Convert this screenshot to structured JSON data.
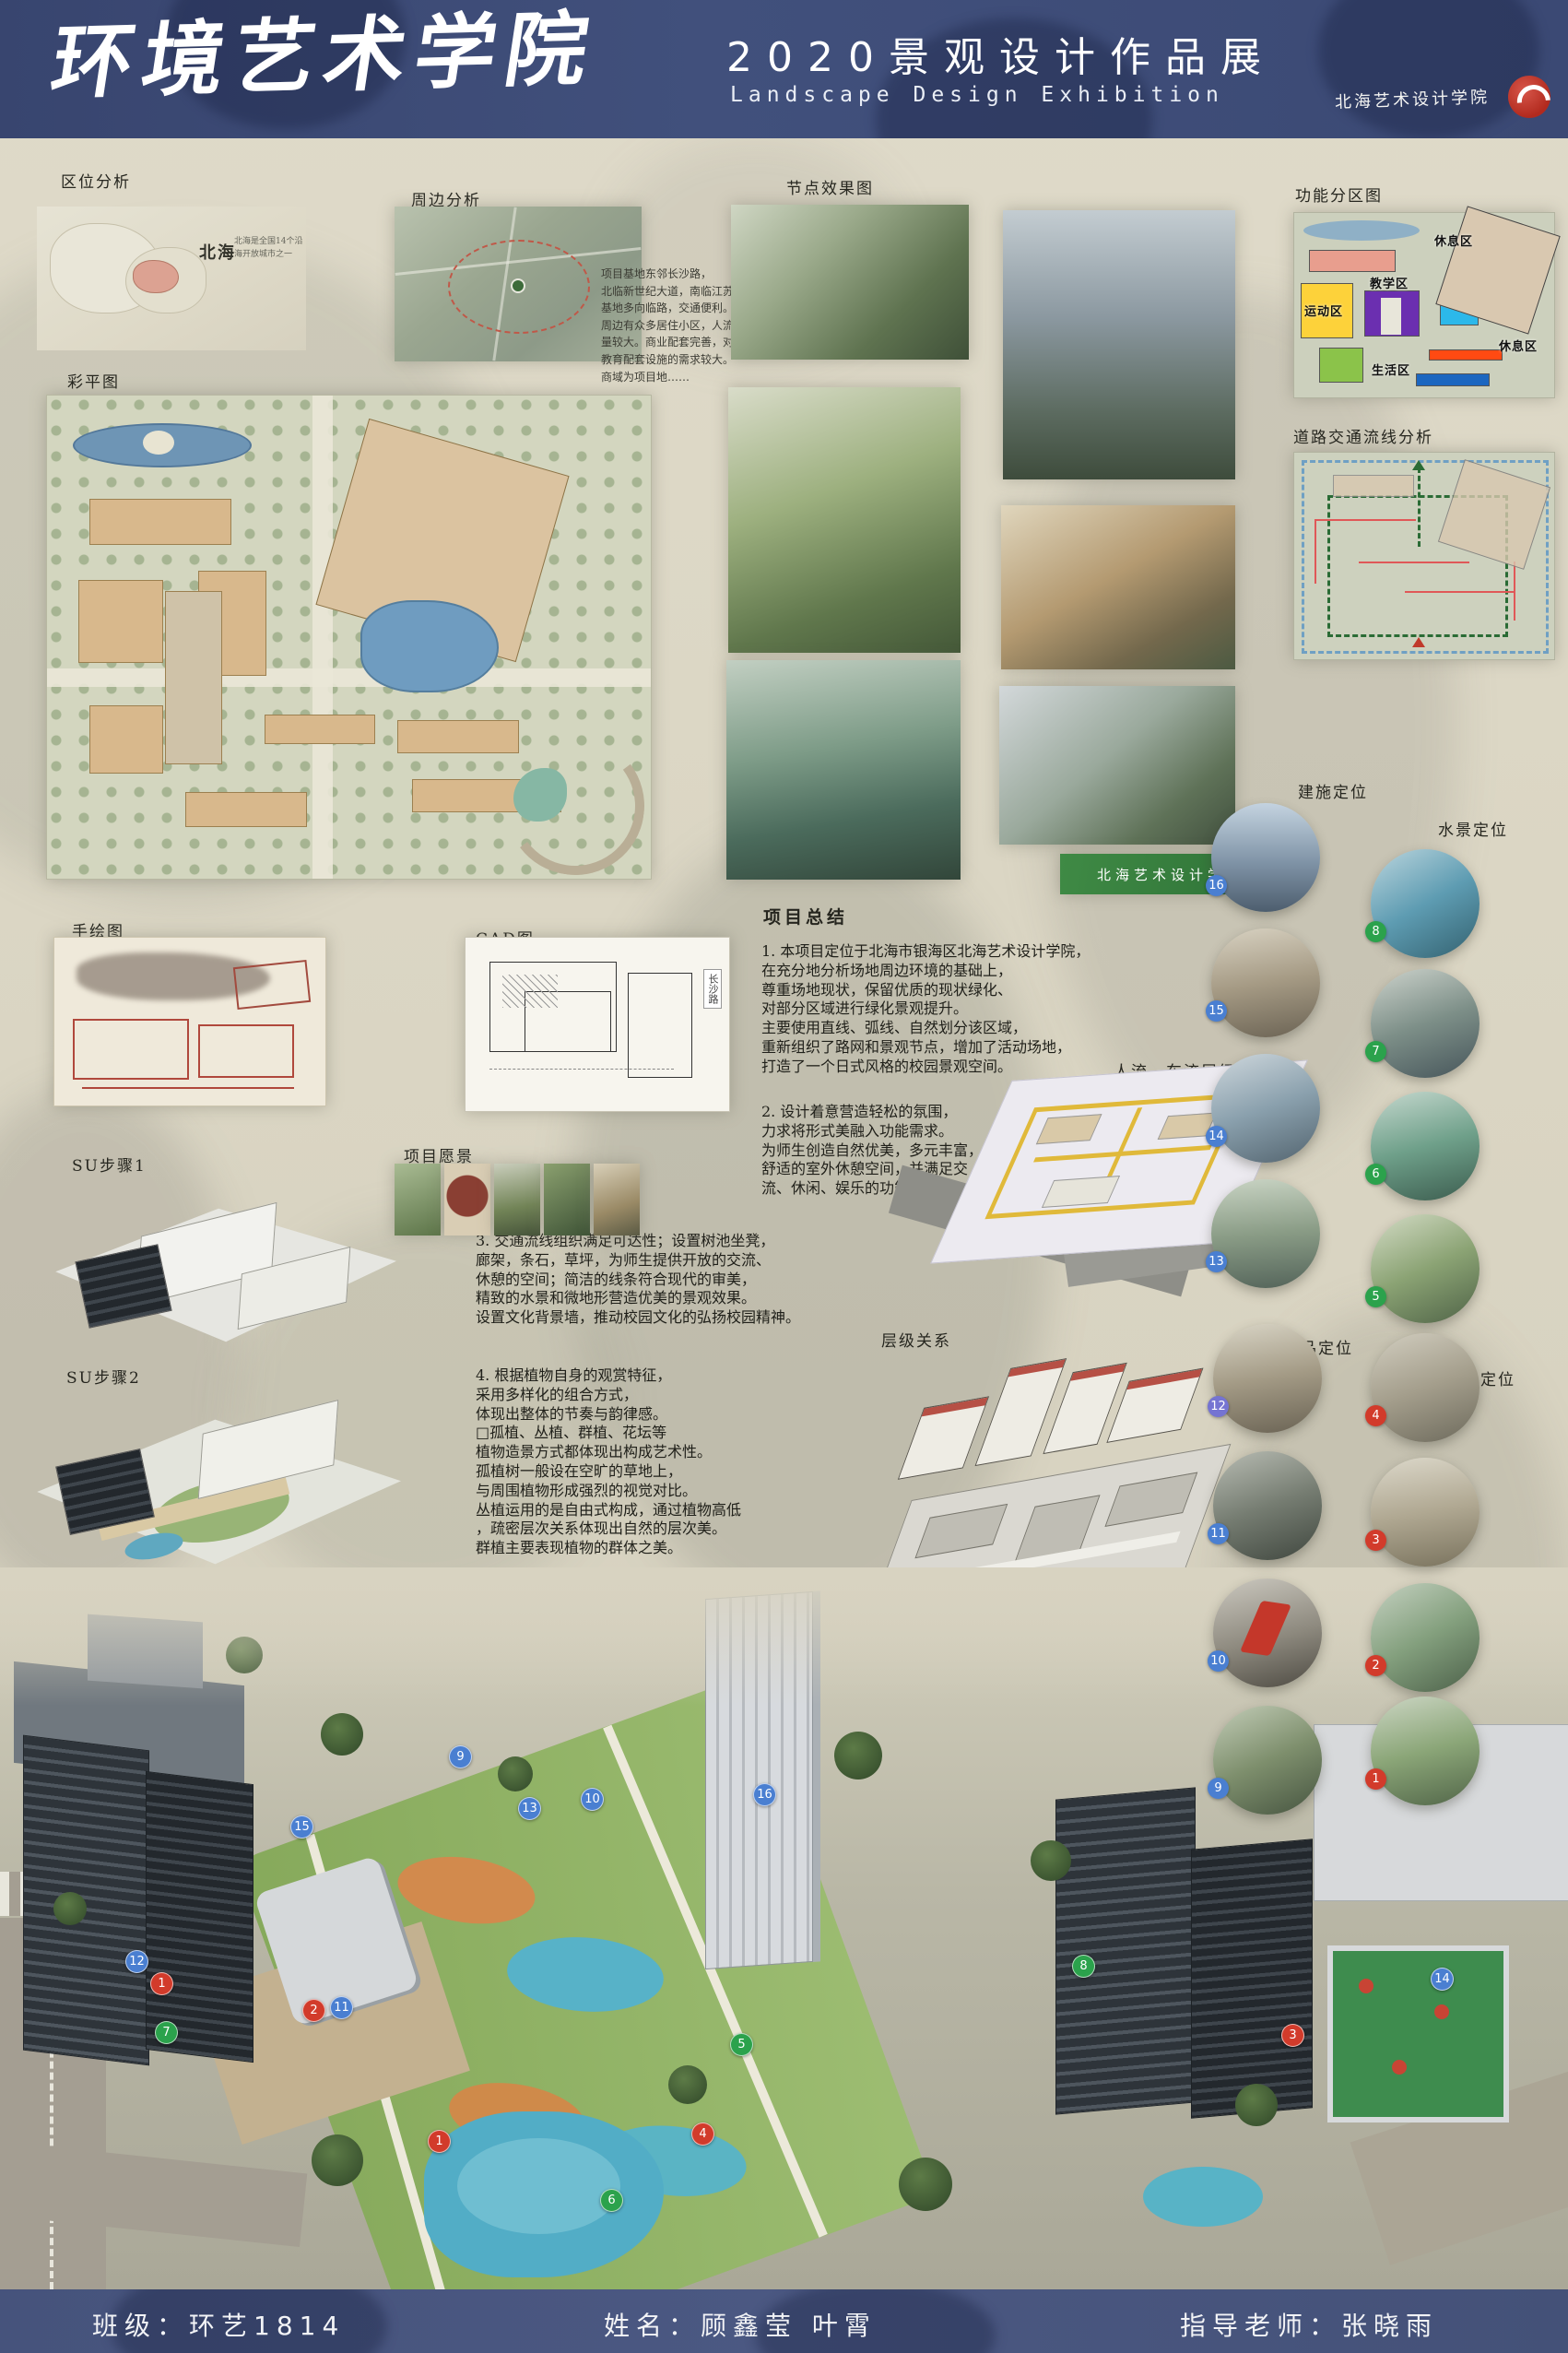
{
  "header": {
    "title": "环境艺术学院",
    "subtitle": "2020景观设计作品展",
    "subtitle_en": "Landscape Design Exhibition",
    "seal_text": "北海艺术设计学院"
  },
  "labels": {
    "location": "区位分析",
    "surrounding": "周边分析",
    "node_effects": "节点效果图",
    "function_zoning": "功能分区图",
    "traffic": "道路交通流线分析",
    "color_plan": "彩平图",
    "hand_drawing": "手绘图",
    "cad": "CAD图",
    "summary": "项目总结",
    "su_step1": "SU步骤1",
    "vision": "项目愿景",
    "su_step2": "SU步骤2",
    "aerial": "鸟瞰图",
    "flow": "人流，车流层级图",
    "hierarchy": "层级关系",
    "building_pos": "建施定位",
    "water_pos": "水景定位",
    "feature_pos": "小品定位",
    "paving_pos": "铺装定位"
  },
  "location_map": {
    "city": "北海",
    "note": "北海是全国14个沿海开放城市之一"
  },
  "surrounding_note": "项目基地东邻长沙路，\n北临新世纪大道，南临江苏路。\n基地多向临路，交通便利。\n周边有众多居住小区，人流\n量较大。商业配套完善，对\n教育配套设施的需求较大。\n商域为项目地……",
  "zones": {
    "rest1": "休息区",
    "teaching": "教学区",
    "sports": "运动区",
    "living": "生活区",
    "rest2": "休息区"
  },
  "cad_road_label": "长沙路",
  "campus_sign": "北海艺术设计学院",
  "summary": {
    "p1": "1. 本项目定位于北海市银海区北海艺术设计学院，\n在充分地分析场地周边环境的基础上，\n尊重场地现状，保留优质的现状绿化、\n对部分区域进行绿化景观提升。\n主要使用直线、弧线、自然划分该区域，\n重新组织了路网和景观节点，增加了活动场地，\n打造了一个日式风格的校园景观空间。",
    "p2": "2. 设计着意营造轻松的氛围，\n力求将形式美融入功能需求。\n为师生创造自然优美，多元丰富，\n舒适的室外休憩空间，并满足交\n流、休闲、娱乐的功能需求。",
    "p3": "3. 交通流线组织满足可达性；设置树池坐凳，\n廊架，条石，草坪，为师生提供开放的交流、\n休憩的空间；简洁的线条符合现代的审美，\n精致的水景和微地形营造优美的景观效果。\n设置文化背景墙，推动校园文化的弘扬校园精神。",
    "p4": "4. 根据植物自身的观赏特征，\n采用多样化的组合方式，\n体现出整体的节奏与韵律感。\n□孤植、丛植、群植、花坛等\n植物造景方式都体现出构成艺术性。\n孤植树一般设在空旷的草地上，\n与周围植物形成强烈的视觉对比。\n丛植运用的是自由式构成，通过植物高低\n，疏密层次关系体现出自然的层次美。\n群植主要表现植物的群体之美。"
  },
  "positioning": {
    "building": {
      "badges": [
        "16",
        "15",
        "14",
        "13"
      ]
    },
    "water": {
      "badges": [
        "8",
        "7",
        "6",
        "5"
      ]
    },
    "feature": {
      "badges": [
        "12",
        "11",
        "10",
        "9"
      ]
    },
    "paving": {
      "badges": [
        "4",
        "3",
        "2",
        "1"
      ]
    }
  },
  "aerial_markers": [
    {
      "n": "9"
    },
    {
      "n": "13"
    },
    {
      "n": "10"
    },
    {
      "n": "16"
    },
    {
      "n": "15"
    },
    {
      "n": "12"
    },
    {
      "n": "1"
    },
    {
      "n": "7"
    },
    {
      "n": "2"
    },
    {
      "n": "11"
    },
    {
      "n": "5"
    },
    {
      "n": "8"
    },
    {
      "n": "3"
    },
    {
      "n": "14"
    },
    {
      "n": "4"
    },
    {
      "n": "6"
    },
    {
      "n": "1"
    }
  ],
  "footer": {
    "class_info": "班级：环艺1814",
    "names": "姓名：顾鑫莹  叶霄",
    "advisor": "指导老师：张晓雨"
  },
  "colors": {
    "header_blue": "#3b4974",
    "footer_blue": "#49567f",
    "badge_blue": "#4a7fd1",
    "badge_green": "#2ba24c",
    "badge_red": "#d23b2b",
    "zone_pink": "#e89e8e",
    "zone_yellow": "#fdd23a",
    "zone_purple": "#6b2fb0",
    "zone_cyan": "#2cb8ea",
    "zone_green": "#8bc34a",
    "zone_orange": "#ff4a12",
    "zone_blue": "#1b66c0"
  }
}
